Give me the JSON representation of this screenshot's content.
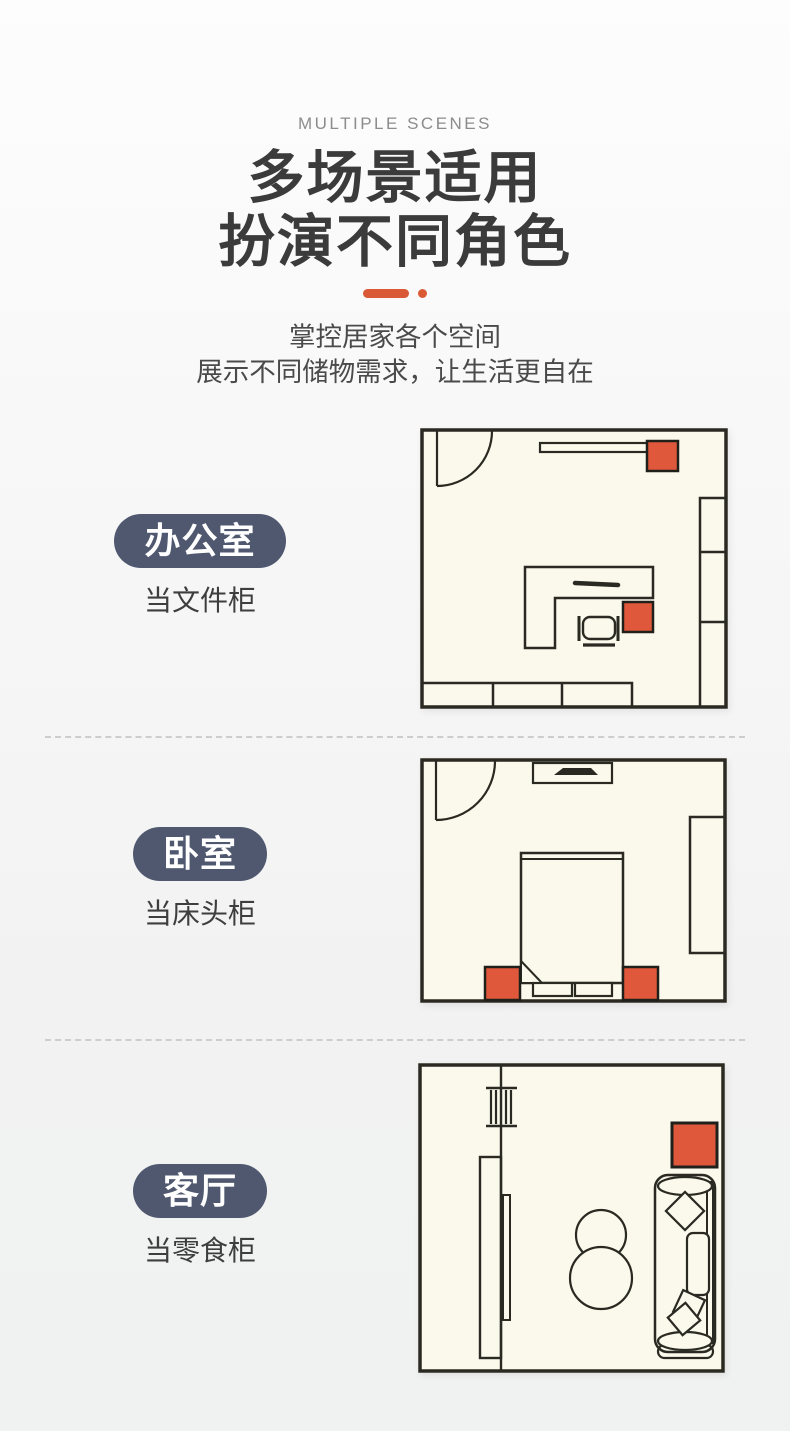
{
  "header": {
    "eyebrow": "MULTIPLE SCENES",
    "title_line1": "多场景适用",
    "title_line2": "扮演不同角色",
    "subtitle_line1": "掌控居家各个空间",
    "subtitle_line2": "展示不同储物需求，让生活更自在"
  },
  "scenes": [
    {
      "tag": "办公室",
      "caption": "当文件柜"
    },
    {
      "tag": "卧室",
      "caption": "当床头柜"
    },
    {
      "tag": "客厅",
      "caption": "当零食柜"
    }
  ],
  "colors": {
    "accent_orange": "#E0583B",
    "divider_orange": "#D95A35",
    "pill_background": "#505870",
    "plan_background": "#FAF9EC",
    "plan_line": "#2A2922",
    "title_color": "#3B3B3B"
  },
  "icons": [
    "door-swing-icon",
    "desk-icon",
    "office-chair-icon",
    "cabinet-icon",
    "bed-icon",
    "pillow-icon",
    "wardrobe-icon",
    "window-icon",
    "tv-cabinet-icon",
    "coffee-table-icon",
    "sofa-icon",
    "storage-cabinet-marker"
  ]
}
